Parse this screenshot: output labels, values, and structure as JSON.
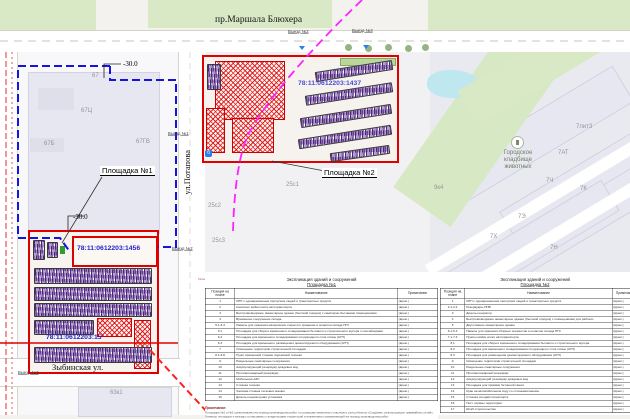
{
  "colors": {
    "site_outline": "#e10000",
    "work_boundary": "#1414dd",
    "parking_hatch": "#6a3d9a",
    "demolition_line": "#ff22ff",
    "cadastral_text": "#2222cc",
    "road_marking": "#e03030"
  },
  "streets": {
    "top": "пр.Маршала Блюхера",
    "vertical": "ул.Потапова",
    "bottom": "Зыбинская ул."
  },
  "exits": {
    "top_left": "Выезд №2",
    "top_right": "Выезд №3",
    "mid_top": "Выезд №1",
    "mid_bottom": "Выезд №2",
    "bottom_left": "Выезд №3"
  },
  "sites": {
    "site1": {
      "label": "Площадка №1",
      "cad1": "78:11:0612203:1456",
      "cad2": "78:11:0612203:15",
      "offset_top": "-30.0",
      "offset_bottom": "-30.0"
    },
    "site2": {
      "label": "Площадка №2",
      "cad": "78:11:0612203:1437"
    }
  },
  "poi": {
    "cemetery_line1": "Городское",
    "cemetery_line2": "кладбище",
    "cemetery_line3": "животных",
    "bus_stop": "б"
  },
  "labels": {
    "b67": "67",
    "b67c": "67Ц",
    "b67b": "67Б",
    "b67gv": "67ГВ",
    "b25s1": "25с1",
    "b25s2": "25с2",
    "b25s3": "25с3",
    "b63k1": "63к1",
    "b7lit3": "7лит3",
    "b7at": "7АТ",
    "b7ch": "7Ч",
    "b7k": "7К",
    "b7e": "7Э",
    "b7h": "7Х",
    "b7n": "7Н",
    "b9k4": "9к4"
  },
  "legend_note": "Условные обозначения",
  "tables": [
    {
      "title": "Экспликация зданий и сооружений",
      "subtitle": "Площадка №1",
      "headers": [
        "Позиция на плане",
        "Наименование",
        "Примечание"
      ],
      "rows": [
        [
          "1",
          "КПП с одновременным пропуском людей и транспортных средств",
          "(врем.)"
        ],
        [
          "2",
          "Комплекс мойки колёс автотранспорта",
          "(врем.)"
        ],
        [
          "3",
          "Быстровозводимое инвентарное здание (бытовой городок) с санитарно-бытовыми помещениями",
          "(врем.)"
        ],
        [
          "4",
          "Временное сооружение склада",
          "(врем.)"
        ],
        [
          "5.1-5.4",
          "Навесы для хранения материалов открытого хранения и оснастки склада ПГС",
          "(врем.)"
        ],
        [
          "6.1",
          "Площадка для сбора и временного складирования бытового и строительного мусора с контейнерами",
          "(врем.)"
        ],
        [
          "6.2",
          "Площадка для временного складирования плодородного слоя почвы (АГП)",
          "(врем.)"
        ],
        [
          "6.3",
          "Площадка для временного размещения демонтируемого оборудования (АГП)",
          "(врем.)"
        ],
        [
          "7",
          "Освещение территории строительной площадки",
          "(врем.)"
        ],
        [
          "8.1-8.8",
          "Пункт временной стоянки подъёмной техники",
          "(врем.)"
        ],
        [
          "9",
          "Раздельные санитарные сооружения",
          "(врем.)"
        ],
        [
          "10",
          "Аккумулирующий резервуар дождевых вод",
          "(врем.)"
        ],
        [
          "11",
          "Противопожарный резервуар",
          "(врем.)"
        ],
        [
          "12",
          "Мобильная АЗС",
          "(врем.)"
        ],
        [
          "13",
          "Стоянка техники",
          "(врем.)"
        ],
        [
          "14",
          "Часовая стоянка легковых машин",
          "(врем.)"
        ],
        [
          "15",
          "Дизель-генераторная установка",
          "(врем.)"
        ]
      ],
      "footnote_label": "Примечание:",
      "footnote_line1": "Площадки №1 и №2 организованы на период производства работ по границам земельных участков и улиц объекта «Создание, реконструкция трамвайных путей».",
      "footnote_line2": "Границы площадок и выезды согласованы с владельцами территорий и инженерных коммуникаций на период производства работ."
    },
    {
      "title": "Экспликация зданий и сооружений",
      "subtitle": "Площадка №2",
      "headers": [
        "Позиция на плане",
        "Наименование",
        "Примечание"
      ],
      "rows": [
        [
          "1",
          "КПП с одновременным пропуском людей и транспортных средств",
          "(врем.)"
        ],
        [
          "2.1-2.2",
          "Резервуары ППВ",
          "(врем.)"
        ],
        [
          "3",
          "Дизель-генератор",
          "(врем.)"
        ],
        [
          "4",
          "Быстровозводимое инвентарное здание (бытовой городок) с помещениями для рабочих",
          "(врем.)"
        ],
        [
          "5",
          "Двухэтажное инвентарное здание",
          "(врем.)"
        ],
        [
          "6.1-6.3",
          "Навесы для хранения сборных элементов и оснастки склада ПГС",
          "(врем.)"
        ],
        [
          "7.1-7.3",
          "Пункты мойки колёс автотранспорта",
          "(врем.)"
        ],
        [
          "8.1",
          "Площадка для сбора и временного складирования бытового и строительного мусора",
          "(врем.)"
        ],
        [
          "8.2",
          "Площадка для временного складирования плодородного слоя почвы (АГП)",
          "(врем.)"
        ],
        [
          "8.3",
          "Площадка для размещения демонтируемого оборудования (АГП)",
          "(врем.)"
        ],
        [
          "9",
          "Освещение территории строительной площадки",
          "(врем.)"
        ],
        [
          "10",
          "Раздельные санитарные сооружения",
          "(врем.)"
        ],
        [
          "11",
          "Противопожарный резервуар",
          "(врем.)"
        ],
        [
          "12",
          "Аккумулирующий резервуар дождевых вод",
          "(врем.)"
        ],
        [
          "13",
          "Площадка для приёмки бетонной смеси",
          "(врем.)"
        ],
        [
          "14",
          "Кран на автомобильном ходу со стоянками машин",
          "(врем.)"
        ],
        [
          "15",
          "Стоянка спецавтотранспорта",
          "(врем.)"
        ],
        [
          "16",
          "Пост охраны территории",
          "(врем.)"
        ],
        [
          "17",
          "Штаб строительства",
          "(врем.)"
        ]
      ]
    }
  ]
}
